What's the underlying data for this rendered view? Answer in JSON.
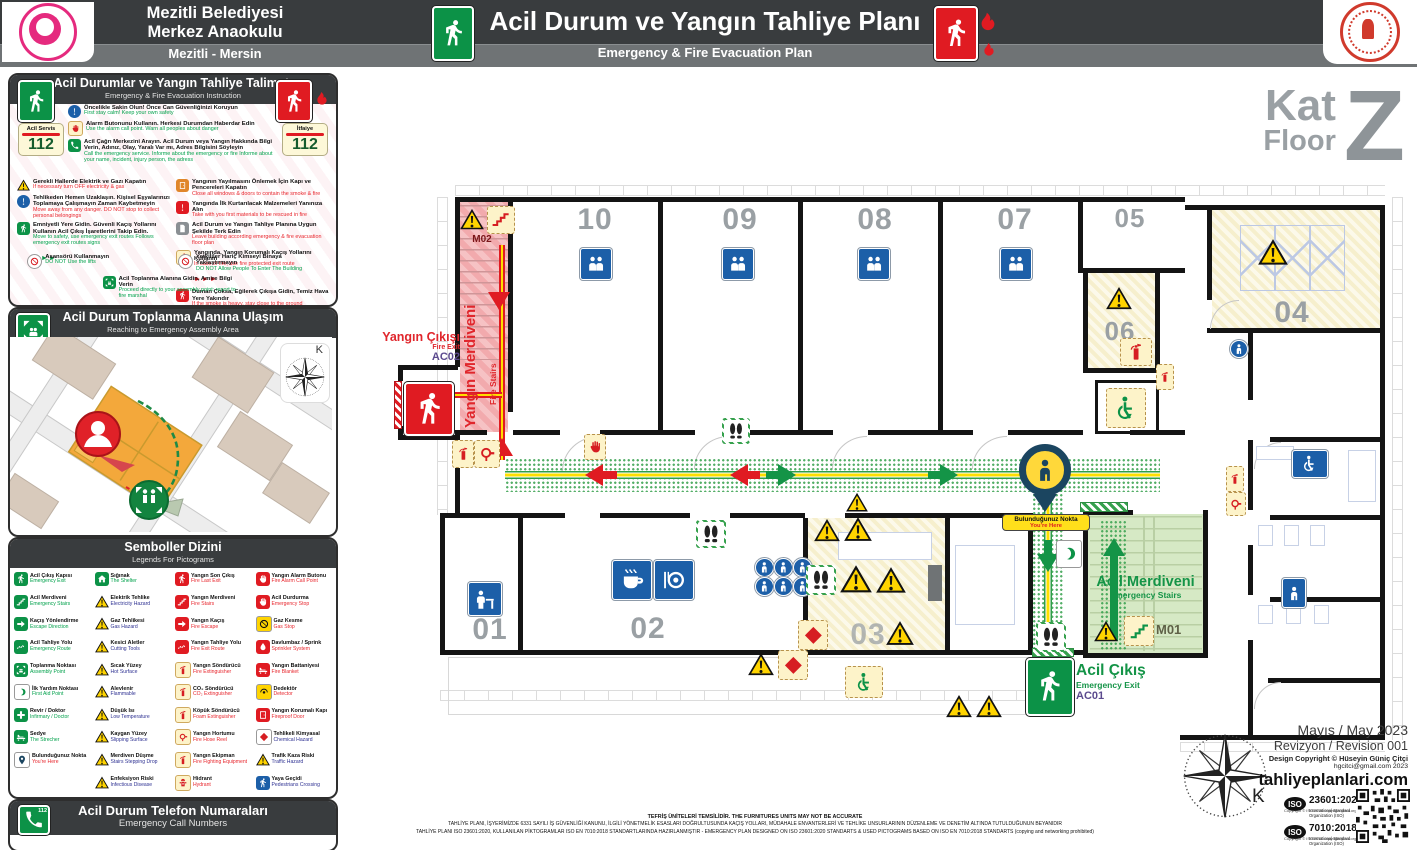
{
  "header": {
    "line1": "Mezitli Belediyesi",
    "line2": "Merkez Anaokulu",
    "city": "Mezitli - Mersin",
    "title": "Acil Durum ve Yangın Tahliye Planı",
    "sub": "Emergency & Fire Evacuation Plan"
  },
  "inst": {
    "title": "Acil Durumlar ve Yangın Tahliye Talimatı",
    "sub": "Emergency & Fire Evacuation Instruction",
    "badgeL": {
      "label": "Acil Servis",
      "num": "112"
    },
    "badgeR": {
      "label": "İtfaiye",
      "num": "112"
    },
    "top": [
      {
        "n": "info-icon",
        "v": "binfo",
        "s": "s-excl",
        "tr": "Öncelikle Sakin Olun! Önce Can Güvenliğinizi Koruyun",
        "en": "First stay calm! Keep your own safety",
        "c": "g"
      },
      {
        "n": "alarm-button-icon",
        "v": "fy",
        "s": "s-hand",
        "tr": "Alarm Butonunu Kullanın. Herkesi Durumdan Haberdar Edin",
        "en": "Use the alarm call point. Warn all peoples about danger",
        "c": "g"
      },
      {
        "n": "emergency-call-icon",
        "v": "gsq",
        "s": "s-phone",
        "tr": "Acil Çağrı Merkezini Arayın. Acil Durum veya Yangın Hakkında Bilgi Verin, Adınız, Olay, Yaralı Var mı, Adres Bilgisini Söyleyin",
        "en": "Call the emergency service. Informe about the emergency or fire Informe about your name, incident, injury person, the adress",
        "c": "g"
      }
    ],
    "left": [
      {
        "n": "turn-off-electricity-gas-icon",
        "v": "warn",
        "s": "s-warn-tri",
        "tr": "Gerekli Hallerde Elektrik ve Gazı Kapatın",
        "en": "If necessary turn OFF electricity & gas",
        "c": "r"
      },
      {
        "n": "move-away-icon",
        "v": "binfo",
        "s": "s-excl",
        "tr": "Tehlikeden Hemen Uzaklaşın. Kişisel Eşyalarınızı Toplamaya Çalışmayın Zaman Kaybetmeyin",
        "en": "Move away from any danger. DO NOT stop to collect personal belongings",
        "c": "r"
      },
      {
        "n": "safe-exit-icon",
        "v": "gsq",
        "s": "s-runner",
        "tr": "Emniyetli Yere Gidin. Güvenli Kaçış Yollarını Kullanın Acil Çıkış İşaretlerini Takip Edin.",
        "en": "Move to safety, use emergency exit routes Follows emergency exit routes signs",
        "c": "g",
        "ar": "g"
      }
    ],
    "right": [
      {
        "n": "close-doors-icon",
        "v": "osq",
        "s": "s-door",
        "tr": "Yangının Yayılmasını Önlemek İçin Kapı ve Pencereleri Kapatın",
        "en": "Close all windows & doors to contain the smoke & fire",
        "c": "r"
      },
      {
        "n": "rescue-materials-icon",
        "v": "rsq",
        "s": "s-excl",
        "tr": "Yangında İlk Kurtarılacak Malzemeleri Yanınıza Alın",
        "en": "Take with you first materials to be rescued in fire",
        "c": "r"
      },
      {
        "n": "evacuation-plan-icon",
        "v": "gray",
        "s": "s-doc",
        "tr": "Acil Durum ve Yangın Tahliye Planına Uygun Şekilde Terk Edin",
        "en": "Leave building according emergency & fire evacuation floor plan",
        "c": "r"
      },
      {
        "n": "fire-protected-route-icon",
        "v": "fy",
        "s": "s-runner",
        "tr": "Yangında, Yangın Korumalı Kaçış Yollarını Kullanın",
        "en": "In case of fire, use fire protected exit route",
        "c": "r",
        "ar": "r"
      },
      {
        "n": "crawl-low-icon",
        "v": "rsq",
        "s": "s-runner",
        "tr": "Duman Çoksa, Eğilerek Çıkışa Gidin, Temiz Hava Yere Yakındır",
        "en": "If the smoke is heavy, stay close to the ground",
        "c": "r"
      }
    ],
    "bottom": [
      {
        "n": "no-elevator-icon",
        "v": "no",
        "s": "s-no",
        "tr": "Asansörü Kullanmayın",
        "en": "DO NOT Use the lifts",
        "c": "g"
      },
      {
        "n": "no-entry-icon",
        "v": "no",
        "s": "s-no",
        "tr": "Yetkililer Hariç Kimseyi Binaya Yaklaştırmayın",
        "en": "DO NOT Allow People To Enter The Building",
        "c": "g"
      },
      {
        "n": "assembly-report-icon",
        "v": "gsq",
        "s": "s-assembly",
        "tr": "Acil Toplanma Alanına Gidin, Amire Bilgi Verin",
        "en": "Proceed directly to your assembly point; report to fire marshal",
        "c": "g"
      }
    ]
  },
  "map": {
    "title": "Acil Durum Toplanma Alanına Ulaşım",
    "sub": "Reaching to Emergency Assembly Area",
    "k": "K"
  },
  "legend": {
    "title": "Semboller Dizini",
    "sub": "Legends For Pictograms",
    "col1": [
      {
        "n": "emergency-exit-icon",
        "v": "g",
        "s": "s-runner",
        "tr": "Acil Çıkış Kapısı",
        "en": "Emergency Exit",
        "c": "g"
      },
      {
        "n": "emergency-stairs-icon",
        "v": "g",
        "s": "s-stairs",
        "tr": "Acil Merdiveni",
        "en": "Emergency Stairs",
        "c": "g"
      },
      {
        "n": "escape-direction-icon",
        "v": "g",
        "s": "s-arrow",
        "tr": "Kaçış Yönlendirme",
        "en": "Escape Direction",
        "c": "g"
      },
      {
        "n": "emergency-route-icon",
        "v": "g",
        "s": "s-route",
        "tr": "Acil Tahliye Yolu",
        "en": "Emergency Route",
        "c": "g"
      },
      {
        "n": "assembly-point-icon",
        "v": "g",
        "s": "s-assembly",
        "tr": "Toplanma Noktası",
        "en": "Assembly Point",
        "c": "g"
      },
      {
        "n": "first-aid-point-icon",
        "v": "wg",
        "s": "s-crescent",
        "tr": "İlk Yardım Noktası",
        "en": "First Aid Point",
        "c": "g"
      },
      {
        "n": "infirmary-icon",
        "v": "g",
        "s": "s-cross",
        "tr": "Revir / Doktor",
        "en": "Infirmary / Doctor",
        "c": "g"
      },
      {
        "n": "stretcher-icon",
        "v": "g",
        "s": "s-bed",
        "tr": "Sedye",
        "en": "The Strecher",
        "c": "g"
      },
      {
        "n": "you-are-here-icon",
        "v": "navy",
        "s": "s-pin",
        "tr": "Bulunduğunuz Nokta",
        "en": "You're Here",
        "c": "r"
      }
    ],
    "col2": [
      {
        "n": "shelter-icon",
        "v": "g",
        "s": "s-shelter",
        "tr": "Sığınak",
        "en": "The Shelter",
        "c": "g"
      },
      {
        "n": "electricity-hazard-icon",
        "v": "warn",
        "s": "s-warn-tri",
        "tr": "Elektrik Tehlike",
        "en": "Electricity Hazard",
        "c": "b"
      },
      {
        "n": "gas-hazard-icon",
        "v": "warn",
        "s": "s-warn-tri",
        "tr": "Gaz Tehlikesi",
        "en": "Gas Hazard",
        "c": "b"
      },
      {
        "n": "cutting-tools-icon",
        "v": "warn",
        "s": "s-warn-tri",
        "tr": "Kesici Aletler",
        "en": "Cutting Tools",
        "c": "b"
      },
      {
        "n": "hot-surface-icon",
        "v": "warn",
        "s": "s-warn-tri",
        "tr": "Sıcak Yüzey",
        "en": "Hot Surface",
        "c": "b"
      },
      {
        "n": "flammable-icon",
        "v": "warn",
        "s": "s-warn-tri",
        "tr": "Alevlenir",
        "en": "Flammable",
        "c": "b"
      },
      {
        "n": "low-temperature-icon",
        "v": "warn",
        "s": "s-warn-tri",
        "tr": "Düşük Isı",
        "en": "Low Temperature",
        "c": "b"
      },
      {
        "n": "slipping-surface-icon",
        "v": "warn",
        "s": "s-warn-tri",
        "tr": "Kaygan Yüzey",
        "en": "Slipping Surface",
        "c": "b"
      },
      {
        "n": "stairs-drop-icon",
        "v": "warn",
        "s": "s-warn-tri",
        "tr": "Merdiven Düşme",
        "en": "Stairs Stepping Drop",
        "c": "b"
      },
      {
        "n": "infectious-disease-icon",
        "v": "warn",
        "s": "s-warn-tri",
        "tr": "Enfeksiyon Riski",
        "en": "Infectious Disease",
        "c": "b"
      }
    ],
    "col3": [
      {
        "n": "fire-last-exit-icon",
        "v": "r",
        "s": "s-runner",
        "tr": "Yangın Son Çıkış",
        "en": "Fire Last Exit",
        "c": "r"
      },
      {
        "n": "fire-stairs-icon",
        "v": "r",
        "s": "s-stairs",
        "tr": "Yangın Merdiveni",
        "en": "Fire Stairs",
        "c": "r"
      },
      {
        "n": "fire-escape-icon",
        "v": "r",
        "s": "s-arrow",
        "tr": "Yangın Kaçış",
        "en": "Fire Escape",
        "c": "r"
      },
      {
        "n": "fire-route-icon",
        "v": "r",
        "s": "s-route",
        "tr": "Yangın Tahliye Yolu",
        "en": "Fire Exit Route",
        "c": "r"
      },
      {
        "n": "fire-extinguisher-icon",
        "v": "fy",
        "s": "s-extinguisher",
        "tr": "Yangın Söndürücü",
        "en": "Fire Extinguisher",
        "c": "r"
      },
      {
        "n": "co2-extinguisher-icon",
        "v": "fy",
        "s": "s-extinguisher",
        "tr": "CO₂ Söndürücü",
        "en": "CO₂ Extinguisher",
        "c": "r"
      },
      {
        "n": "foam-extinguisher-icon",
        "v": "fy",
        "s": "s-extinguisher",
        "tr": "Köpük Söndürücü",
        "en": "Foam Extinguisher",
        "c": "r"
      },
      {
        "n": "fire-hose-icon",
        "v": "fy",
        "s": "s-hose",
        "tr": "Yangın Hortumu",
        "en": "Fire Hose Reel",
        "c": "r"
      },
      {
        "n": "fire-equipment-icon",
        "v": "fy",
        "s": "s-extinguisher",
        "tr": "Yangın Ekipman",
        "en": "Fire Fighting Equipment",
        "c": "r"
      },
      {
        "n": "hydrant-icon",
        "v": "fy",
        "s": "s-hydrant",
        "tr": "Hidrant",
        "en": "Hydrant",
        "c": "r"
      }
    ],
    "col4": [
      {
        "n": "fire-alarm-button-icon",
        "v": "r",
        "s": "s-hand",
        "tr": "Yangın Alarm Butonu",
        "en": "Fire Alarm Call Point",
        "c": "r"
      },
      {
        "n": "emergency-stop-icon",
        "v": "r",
        "s": "s-hand",
        "tr": "Acil Durdurma",
        "en": "Emergency Stop",
        "c": "r"
      },
      {
        "n": "gas-stop-icon",
        "v": "y",
        "s": "s-no",
        "tr": "Gaz Kesme",
        "en": "Gas Stop",
        "c": "r"
      },
      {
        "n": "sprinkler-icon",
        "v": "r",
        "s": "s-drop",
        "tr": "Davlumbaz / Sprink",
        "en": "Sprinkler System",
        "c": "r"
      },
      {
        "n": "fire-blanket-icon",
        "v": "r",
        "s": "s-bed",
        "tr": "Yangın Battaniyesi",
        "en": "Fire Blanket",
        "c": "r"
      },
      {
        "n": "detector-icon",
        "v": "y",
        "s": "s-detector",
        "tr": "Dedektör",
        "en": "Detector",
        "c": "r"
      },
      {
        "n": "fireproof-door-icon",
        "v": "r",
        "s": "s-door",
        "tr": "Yangın Korumalı Kapı",
        "en": "Fireproof Door",
        "c": "r"
      },
      {
        "n": "chemical-hazard-icon",
        "v": "wr",
        "s": "s-diamond",
        "tr": "Tehlikeli Kimyasal",
        "en": "Chemical Hazard",
        "c": "b"
      },
      {
        "n": "traffic-hazard-icon",
        "v": "warn",
        "s": "s-warn-tri",
        "tr": "Trafik Kaza Riski",
        "en": "Traffic Hazard",
        "c": "b"
      },
      {
        "n": "pedestrian-crossing-icon",
        "v": "b",
        "s": "s-runner",
        "tr": "Yaya Geçidi",
        "en": "Pedestrians Crossing",
        "c": "b"
      }
    ]
  },
  "calls": {
    "title": "Acil Durum Telefon Numaraları",
    "sub": "Emergency Call Numbers",
    "num": "112"
  },
  "floor": {
    "kat": "Kat",
    "floor": "Floor",
    "z": "Z"
  },
  "plan": {
    "rooms": [
      "01",
      "02",
      "03",
      "04",
      "05",
      "06",
      "07",
      "08",
      "09",
      "10"
    ],
    "fire_stairs": {
      "tr": "Yangın Merdiveni",
      "en": "Fire Stairs",
      "code": "M02"
    },
    "fire_exit": {
      "tr": "Yangın Çıkışı",
      "en": "Fire Exit",
      "code": "AC02"
    },
    "em_stairs": {
      "tr": "Acil Merdiveni",
      "en": "Emergency Stairs",
      "code": "M01"
    },
    "em_exit": {
      "tr": "Acil Çıkış",
      "en": "Emergency Exit",
      "code": "AC01"
    },
    "here": {
      "tr": "Bulunduğunuz Nokta",
      "en": "You're Here"
    }
  },
  "footer": {
    "date": "Mayıs / May 2023",
    "rev": "Revizyon / Revision 001",
    "copy": "Design Copyright © Hüseyin Güniç Çitçi",
    "email": "hgcitci@gmail.com 2023",
    "site": "tahliyeplanlari.com",
    "k": "K",
    "iso1": {
      "logo": "ISO",
      "code": "23601:2020",
      "l1": "International Standard",
      "l2": "Organization (ISO)",
      "copy": "Copyright © ISO 2020 copyright@iso.org"
    },
    "iso2": {
      "logo": "ISO",
      "code": "7010:2018",
      "l1": "International Standard",
      "l2": "Organization (ISO)",
      "copy": "Copyright © ISO 2011 copyright@iso.org"
    }
  },
  "disc": {
    "l1": "TEFRİŞ ÜNİTELERİ TEMSİLİDİR. THE FURNITURES UNITS MAY NOT BE ACCURATE",
    "l2": "TAHLİYE PLANI, İŞYERİMİZDE 6331 SAYILI İŞ GÜVENLİĞİ KANUNU, İLGİLİ YÖNETMELİK ESASLARI DOĞRULTUSUNDA KAÇIŞ YOLLARI, MÜDAHALE ENVANTERLERİ VE TEHLİKE UNSURLARININ DÜZENLEME VE DENETİM ALTINDA TUTULDUĞUNUN BEYANIDIR",
    "l3": "TAHLİYE PLANI ISO 23601:2020, KULLANILAN PİKTOGRAMLAR ISO EN 7010:2018 STANDARTLARINDA HAZIRLANMIŞTIR - EMERGENCY PLAN DESIGNED ON ISO 23601:2020 STANDARTS & USED PICTOGRAMS BASED ON ISO EN 7010:2018 STANDARTS (copying and networking prohibited)"
  }
}
